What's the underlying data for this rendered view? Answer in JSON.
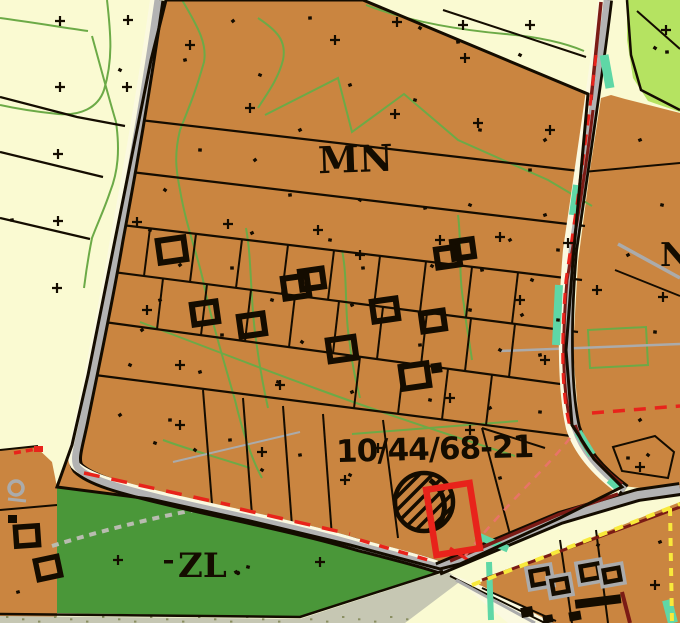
{
  "map_labels": {
    "zone_residential": "MN",
    "zone_forest": "ZL",
    "plot_number": "10/44/68-21",
    "edge_partial_label": "N"
  },
  "legend_colors": {
    "residential_zone_brown": "#CA8540",
    "forest_zone_green": "#4A9739",
    "field_background_cream": "#FAFAD2",
    "meadow_zone_light_green": "#B5E361",
    "road_gray": "#B3B3B3",
    "plot_highlight_red": "#E8231B",
    "boundary_maroon": "#7B1B15",
    "boundary_yellow_dash": "#F8E93B",
    "utility_teal": "#5FD7A6",
    "contour_green": "#6CAA47",
    "line_black": "#140C00"
  }
}
